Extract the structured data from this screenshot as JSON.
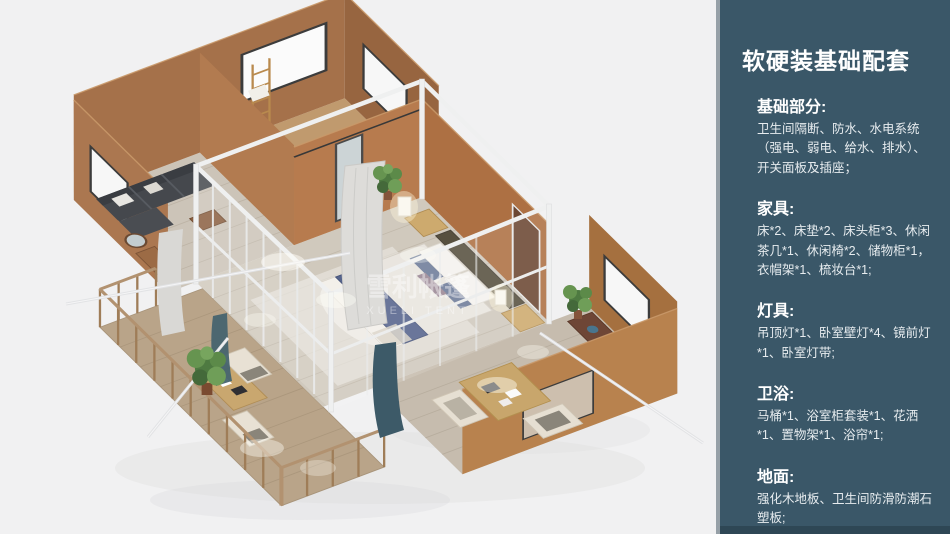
{
  "panel": {
    "title": "软硬装基础配套",
    "background_color": "#3a5768",
    "edge_color": "#96a0a7",
    "sections": [
      {
        "heading": "基础部分:",
        "body": "卫生间隔断、防水、水电系统（强电、弱电、给水、排水）、开关面板及插座；"
      },
      {
        "heading": "家具:",
        "body": "床*2、床垫*2、床头柜*3、休闲茶几*1、休闲椅*2、储物柜*1，衣帽架*1、梳妆台*1;"
      },
      {
        "heading": "灯具:",
        "body": "吊顶灯*1、卧室壁灯*4、镜前灯*1、卧室灯带;"
      },
      {
        "heading": "卫浴:",
        "body": "马桶*1、浴室柜套装*1、花洒*1、置物架*1、浴帘*1;"
      },
      {
        "heading": "地面:",
        "body": "强化木地板、卫生间防滑防潮石塑板;"
      }
    ]
  },
  "illustration": {
    "watermark_cn": "雪利帐篷",
    "watermark_en": "XUELI TENT",
    "background_color": "#f1f1f2",
    "wall_color": "#a9744c",
    "floor_color": "#d0c9bd",
    "bed_accent_color": "#56648c",
    "plant_color": "#5f8a4b"
  }
}
